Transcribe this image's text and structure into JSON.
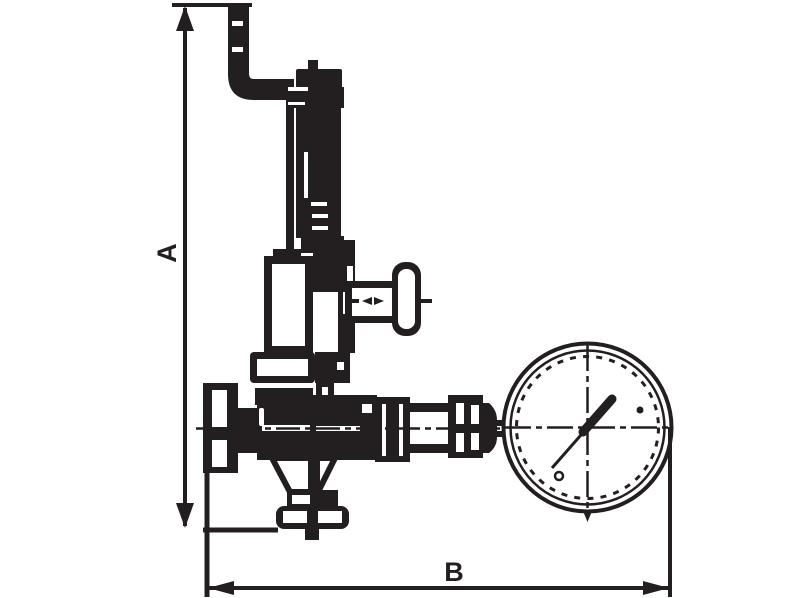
{
  "diagram": {
    "type": "technical-line-drawing",
    "subject": "pressure reducing valve with vent pipe and pressure gauge, side view with overall dimensions",
    "labels": {
      "dimension_vertical": "A",
      "dimension_horizontal": "B"
    },
    "colors": {
      "ink": "#231f20",
      "background": "#ffffff"
    }
  }
}
